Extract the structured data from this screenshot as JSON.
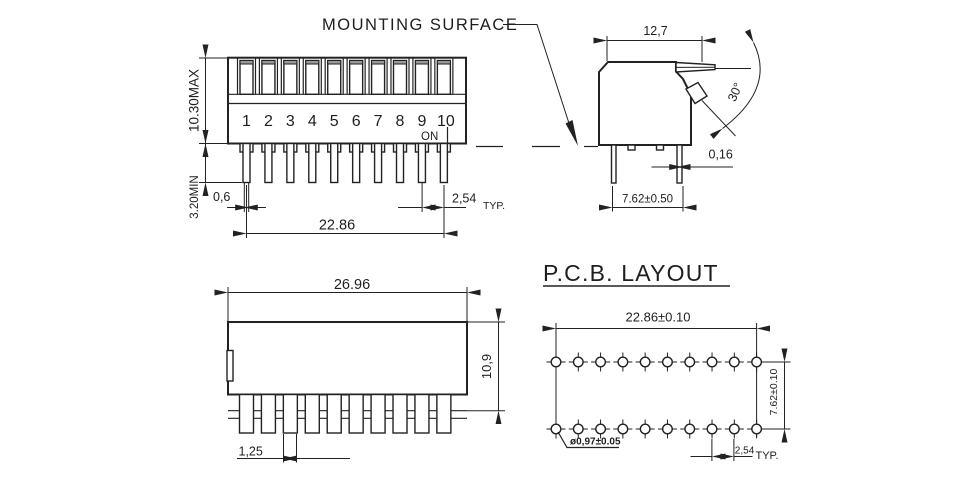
{
  "annotations": {
    "mounting_surface": "MOUNTING SURFACE"
  },
  "front_view": {
    "numbers": [
      "1",
      "2",
      "3",
      "4",
      "5",
      "6",
      "7",
      "8",
      "9",
      "10"
    ],
    "on_label": "ON",
    "switch_positions": 10,
    "dims": {
      "height": "10.30MAX",
      "pin_length": "3.20MIN",
      "pin_width": "0,6",
      "span": "22.86",
      "pitch": "2,54",
      "typ": "TYP."
    }
  },
  "side_view": {
    "dims": {
      "width": "12,7",
      "angle": "30°",
      "gap": "0,16",
      "row_spacing": "7.62±0.50"
    }
  },
  "bottom_view": {
    "dims": {
      "width": "26.96",
      "height": "10,9",
      "pin_width": "1,25"
    }
  },
  "pcb_layout": {
    "title": "P.C.B. LAYOUT",
    "hole_columns": 10,
    "hole_rows": 2,
    "dims": {
      "span": "22.86±0.10",
      "row_spacing": "7.62±0.10",
      "hole_dia": "ø0,97±0.05",
      "pitch": "2,54",
      "typ": "TYP."
    }
  },
  "colors": {
    "line": "#222222",
    "lever_cap": "#999999",
    "background": "#ffffff"
  }
}
